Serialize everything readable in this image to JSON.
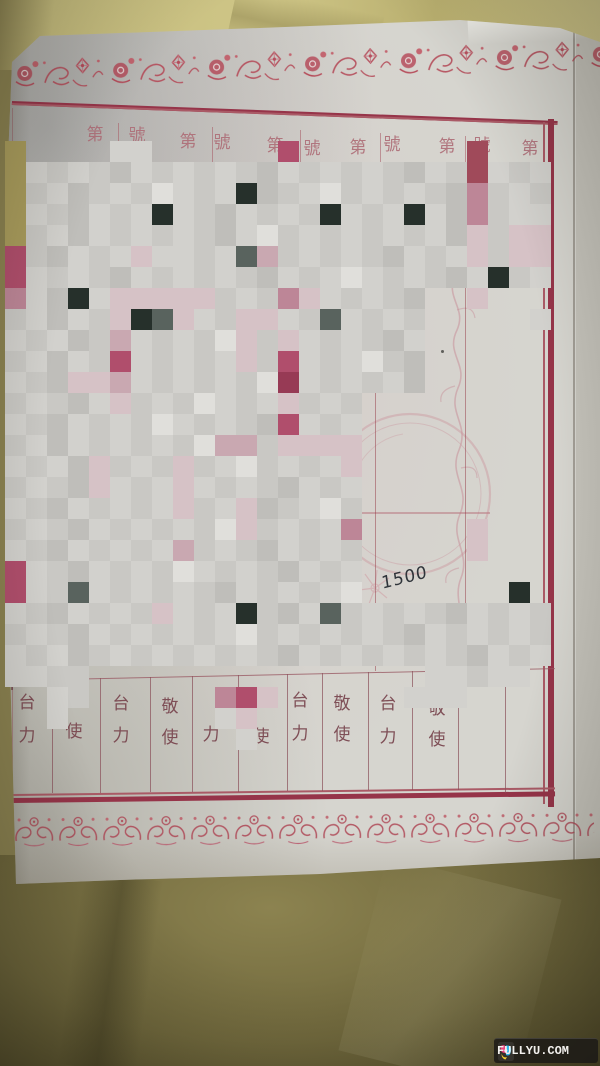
{
  "watermark": {
    "text": "FULLYU.COM"
  },
  "handwriting": {
    "text": "1500",
    "x": 381,
    "y": 568
  },
  "header": {
    "cells": [
      {
        "ch": "第",
        "x": 95,
        "y": 126
      },
      {
        "ch": "號",
        "x": 137,
        "y": 127
      },
      {
        "ch": "第",
        "x": 188,
        "y": 133
      },
      {
        "ch": "號",
        "x": 222,
        "y": 134
      },
      {
        "ch": "第",
        "x": 275,
        "y": 137
      },
      {
        "ch": "號",
        "x": 312,
        "y": 140
      },
      {
        "ch": "第",
        "x": 358,
        "y": 139
      },
      {
        "ch": "號",
        "x": 392,
        "y": 136
      },
      {
        "ch": "第",
        "x": 447,
        "y": 138
      },
      {
        "ch": "號",
        "x": 482,
        "y": 137
      },
      {
        "ch": "第",
        "x": 530,
        "y": 140
      }
    ],
    "dividers": [
      {
        "x": 118,
        "y1": 123,
        "y2": 168
      },
      {
        "x": 212,
        "y1": 127,
        "y2": 171
      },
      {
        "x": 300,
        "y1": 130,
        "y2": 174
      },
      {
        "x": 380,
        "y1": 133,
        "y2": 176
      },
      {
        "x": 465,
        "y1": 136,
        "y2": 178
      }
    ]
  },
  "footer": {
    "columns": [
      {
        "top": "台",
        "bottom": "力",
        "x": 27,
        "yt": 694,
        "yb": 727
      },
      {
        "top": "",
        "bottom": "使",
        "x": 74,
        "yt": 0,
        "yb": 723
      },
      {
        "top": "台",
        "bottom": "力",
        "x": 121,
        "yt": 695,
        "yb": 727
      },
      {
        "top": "敬",
        "bottom": "使",
        "x": 170,
        "yt": 698,
        "yb": 729
      },
      {
        "top": "",
        "bottom": "力",
        "x": 211,
        "yt": 0,
        "yb": 726
      },
      {
        "top": "",
        "bottom": "使",
        "x": 261,
        "yt": 0,
        "yb": 728
      },
      {
        "top": "台",
        "bottom": "力",
        "x": 300,
        "yt": 692,
        "yb": 725
      },
      {
        "top": "敬",
        "bottom": "使",
        "x": 342,
        "yt": 695,
        "yb": 726
      },
      {
        "top": "台",
        "bottom": "力",
        "x": 388,
        "yt": 695,
        "yb": 728
      },
      {
        "top": "敬",
        "bottom": "使",
        "x": 437,
        "yt": 700,
        "yb": 731
      }
    ],
    "dividers": [
      {
        "x": 52,
        "y1": 679,
        "y2": 793
      },
      {
        "x": 100,
        "y1": 678,
        "y2": 793
      },
      {
        "x": 150,
        "y1": 677,
        "y2": 792
      },
      {
        "x": 192,
        "y1": 676,
        "y2": 792
      },
      {
        "x": 238,
        "y1": 675,
        "y2": 792
      },
      {
        "x": 287,
        "y1": 674,
        "y2": 791
      },
      {
        "x": 322,
        "y1": 673,
        "y2": 791
      },
      {
        "x": 368,
        "y1": 672,
        "y2": 790
      },
      {
        "x": 412,
        "y1": 671,
        "y2": 790
      },
      {
        "x": 458,
        "y1": 670,
        "y2": 790
      },
      {
        "x": 505,
        "y1": 669,
        "y2": 793
      }
    ]
  },
  "lines": {
    "long_columns": [
      {
        "x": 375,
        "y1": 170,
        "y2": 671
      },
      {
        "x": 465,
        "y1": 172,
        "y2": 669
      }
    ],
    "left_border": {
      "x": 12,
      "y1": 108,
      "y2": 800
    },
    "header_bottom": {
      "x1": 455,
      "x2": 548,
      "y": 169
    },
    "cross_h": {
      "x1": 358,
      "x2": 487,
      "y": 513
    },
    "dots": [
      {
        "x": 368,
        "y": 608
      },
      {
        "x": 441,
        "y": 350
      }
    ]
  },
  "frame": {
    "thick": "#963449",
    "thin": "#aa5a66"
  },
  "palette": {
    "_": "",
    ".": "#c9c8c4",
    ",": "#d2d1cd",
    "-": "#bfbeba",
    "w": "#e0dfdb",
    "p": "#d6c2c6",
    "P": "#c9a8b1",
    "r": "#bd8697",
    "R": "#b04e6c",
    "Q": "#973a55",
    "q": "#a04a5a",
    "k": "#26302b",
    "g": "#59635e",
    "y": "#a99c5c",
    "o": "#bcae6b"
  },
  "mosaic": {
    "cell": 21,
    "left": 5,
    "top": 141,
    "cols": 26,
    "rows": [
      "y____,,______R________q___",
      "y,.,.-,.,.,.-,.,.,.-,.q,.,",
      "y.,-.,.w,.,k-.,w.,.,.-r.,.",
      "y,.-,.,k,.-,.,.k,.,k,-r.,,",
      "y.,-,.,.,.-,w.,.,.,.,-p.pp",
      "R.-,.,p,,.,gP.,.,.-,.,p.pp",
      "R,.,.-,.,.,.-,.,w,.,.-,k.,",
      "r,-k,ppppp.,.rp,.,.-__p___",
      ".,-,.pkgp,.pp,.g,.,._____,",
      ",.,-.P,.,.wp.p,.,.-,______",
      ".,-,.R,.,.,p.R,.,w.-______",
      ",.-ppP,.,.,.wQ,.,.,-______",
      ".,.-,p.,.w,.,p.,._________",
      ",.-,.,.w,.,.-R,.,_________",
      ".,-,.,.,.wPP.pppp_________",
      ",.,-p.,.p.,w.,.,p_________",
      ".,.-p,.,p,.,.-,.,_________",
      ",.-,.,.,p.,p-.,w._________",
      ".,.-,.,.,.wp.,.,r_____p___",
      ",.-,.,.,P.,.-,.,._____p___",
      "R,.-,.,.w,.,.-,.,_________",
      "R,.g,.,.,.-,.,.,w_______k_",
      ",.-,.,.p,.,k.-,g.,.,.-,.,.",
      ".,.-,.,.,.,w.,.,.,.-,.,.,.",
      ",.,-.,.,.,.,.-,.,.,.,.-,.,",
      ",,..________________,,.,,_",
      "__,.______rRp______,,,____",
      "__,_______,p______________",
      "___________,______________"
    ]
  }
}
